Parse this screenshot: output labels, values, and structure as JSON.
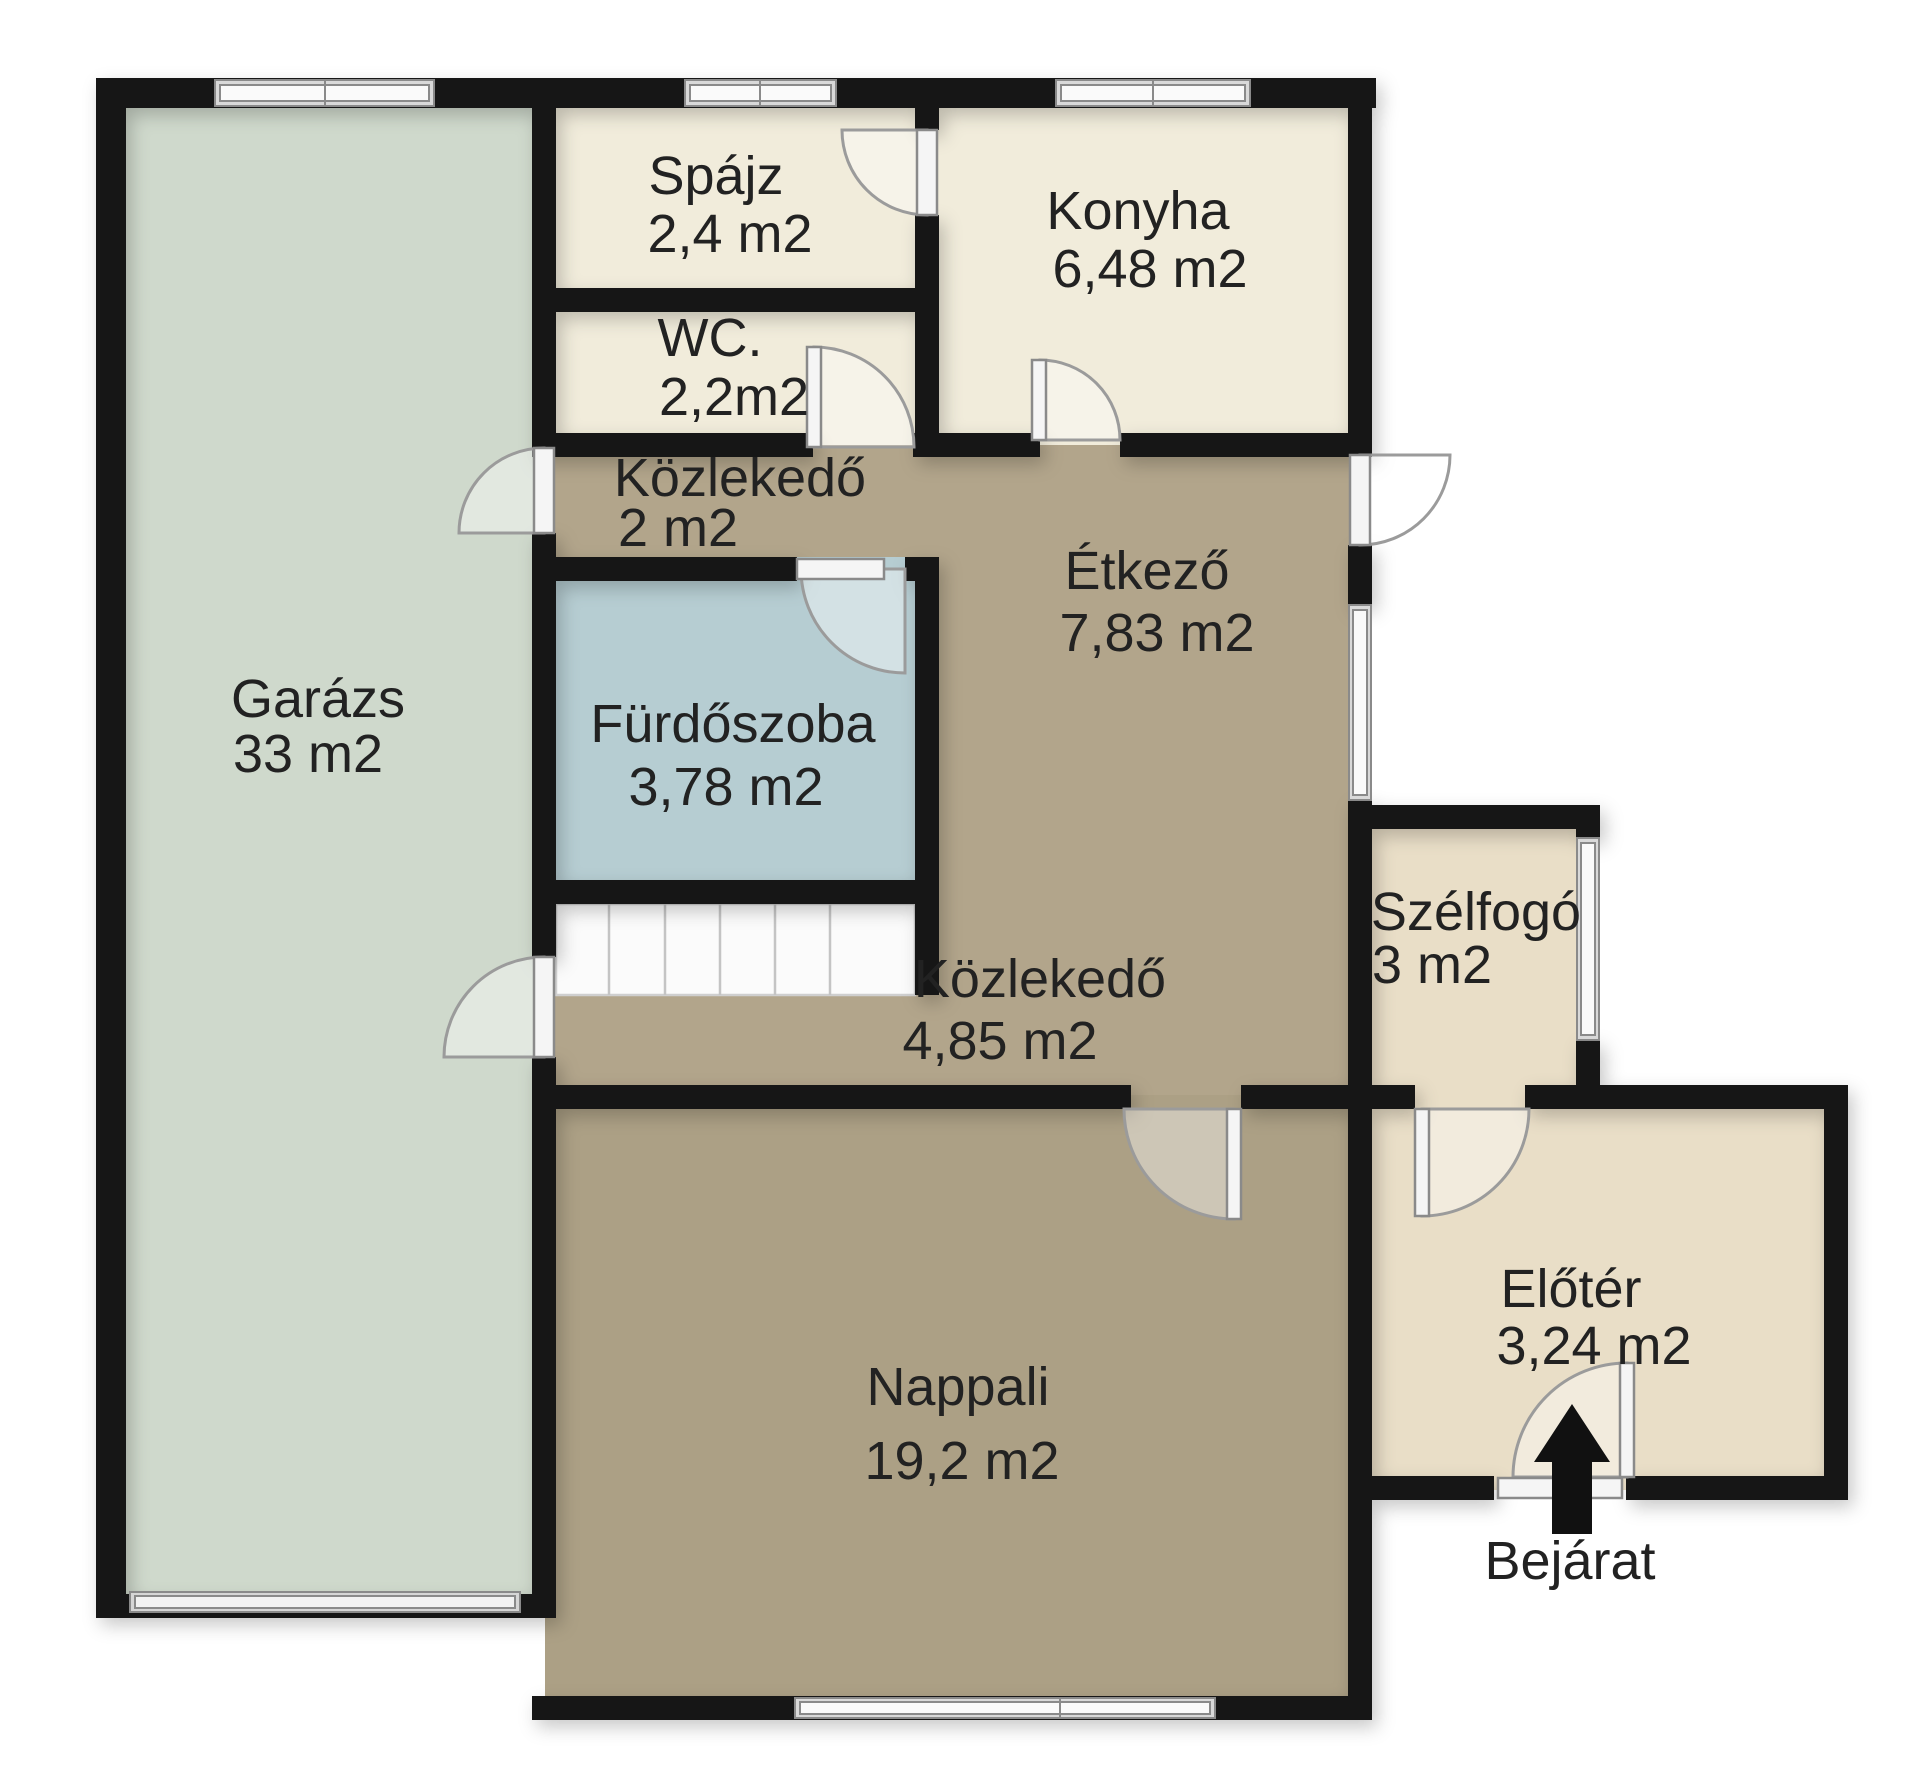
{
  "plan": {
    "rooms": {
      "garazs": {
        "name": "Garázs",
        "area": "33 m2"
      },
      "spajz": {
        "name": "Spájz",
        "area": "2,4 m2"
      },
      "wc": {
        "name": "WC.",
        "area": "2,2m2"
      },
      "konyha": {
        "name": "Konyha",
        "area": "6,48 m2"
      },
      "kozlekedo_felso": {
        "name": "Közlekedő",
        "area": "2 m2"
      },
      "furdoszoba": {
        "name": "Fürdőszoba",
        "area": "3,78 m2"
      },
      "etkezo": {
        "name": "Étkező",
        "area": "7,83 m2"
      },
      "kozlekedo_also": {
        "name": "Közlekedő",
        "area": "4,85 m2"
      },
      "nappali": {
        "name": "Nappali",
        "area": "19,2 m2"
      },
      "szelfogo": {
        "name": "Szélfogó",
        "area": "3 m2"
      },
      "eloter": {
        "name": "Előtér",
        "area": "3,24 m2"
      }
    },
    "entrance_label": "Bejárat",
    "colors": {
      "garage": "#cfd9cc",
      "cream": "#f1ecdb",
      "cream_entry": "#e9dec7",
      "hall_brown": "#b2a58b",
      "living_brown": "#aca085",
      "bathroom_blue": "#b6cdd2",
      "wall": "#161616",
      "stairs": "#fbfbfb",
      "window_frame": "#d9d9d9",
      "label": "#222222",
      "arrow": "#111111"
    }
  }
}
